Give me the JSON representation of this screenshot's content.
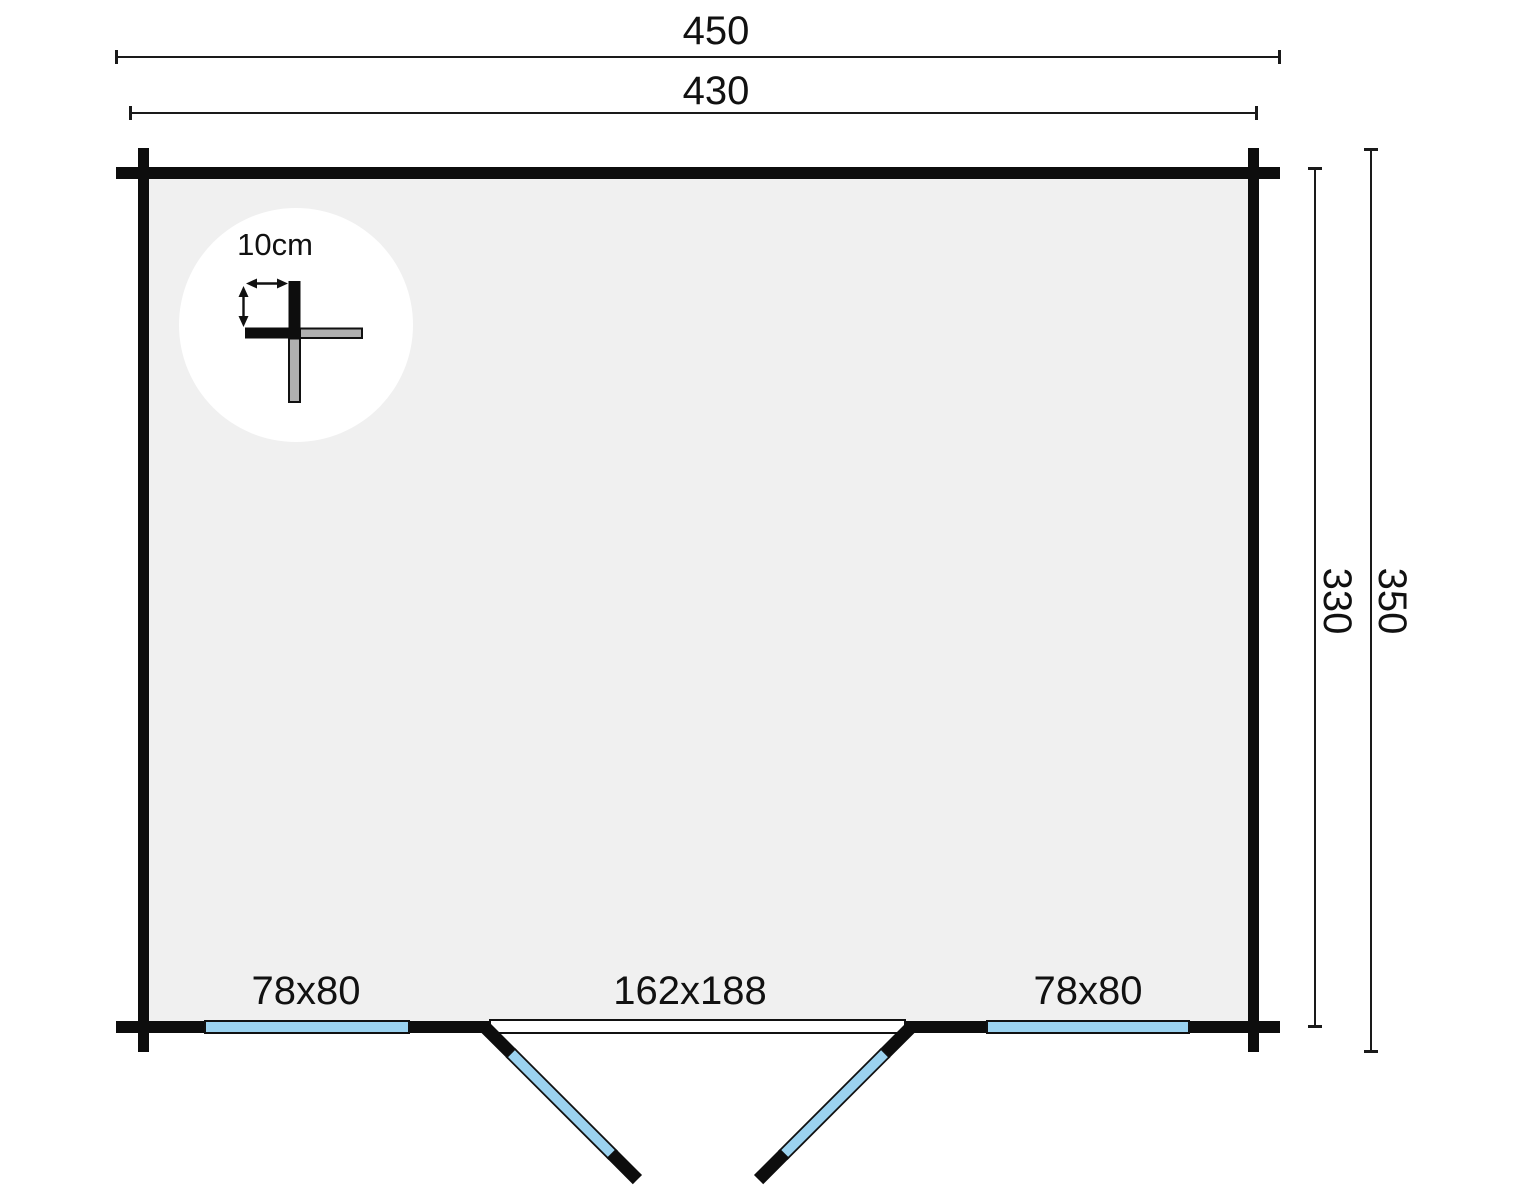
{
  "diagram": {
    "type": "log-cabin-floor-plan",
    "dimension_labels": {
      "outer_width": "450",
      "inner_width": "430",
      "inner_depth": "330",
      "outer_depth": "350"
    },
    "wall_detail": {
      "thickness_label": "10cm"
    },
    "openings": {
      "window_left_label": "78x80",
      "door_label": "162x188",
      "window_right_label": "78x80"
    },
    "colors": {
      "wall_black": "#0d0d0d",
      "floor_gray": "#f0f0f0",
      "glass_blue": "#9bd2ef",
      "log_gray": "#b0b0b0",
      "frame_white": "#ffffff",
      "line_black": "#1a1a1a",
      "background": "#ffffff"
    }
  }
}
